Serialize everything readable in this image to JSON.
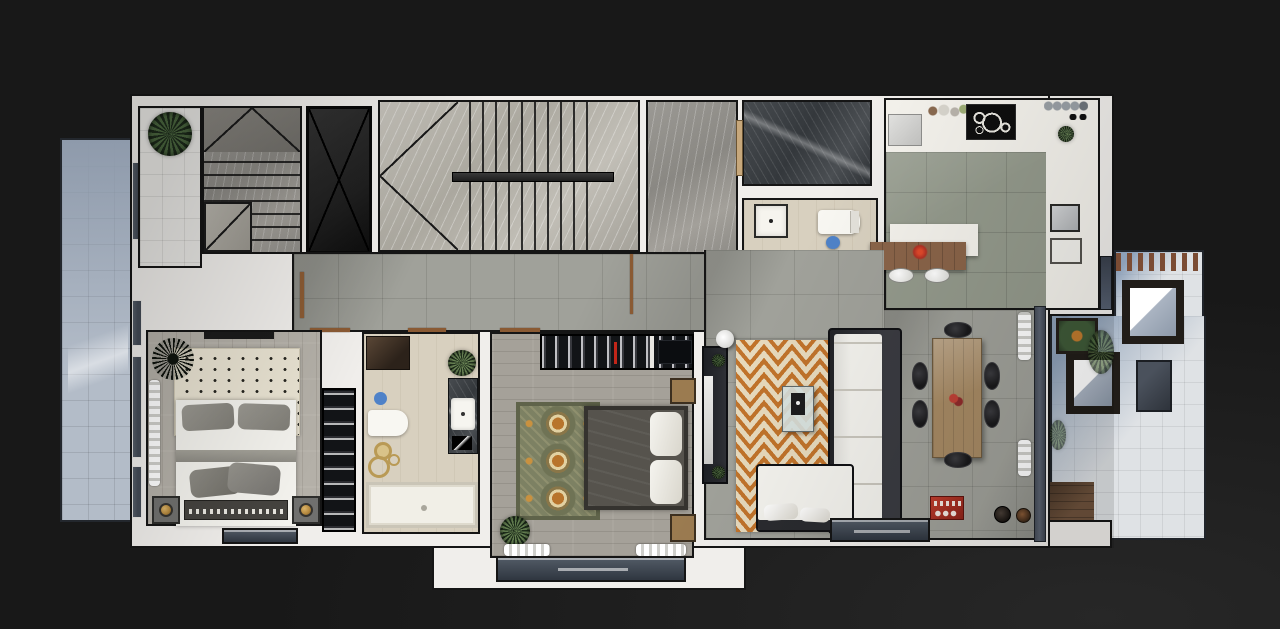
{
  "meta": {
    "scene": "apartment-floor-plan-3d-top-view",
    "text_visible": false
  },
  "palette": {
    "bg": "#181818",
    "bg_glow": "#272727",
    "wall": "#f0eeeb",
    "line": "#151515",
    "balcony_tile": "#b3bcc8",
    "balcony_tile_dark": "#8e9aab",
    "terrace_tile": "#dfe2e5",
    "terrace_shadow": "#8da0b8",
    "white_tile": "#e9e8e5",
    "concrete": "#a0a19a",
    "kitchen_tile": "#949a8c",
    "marble_light": "#bdbab2",
    "marble_mid": "#918f8a",
    "elevator": "#202020",
    "wood_light": "#b4b0a8",
    "wood_mid": "#a5a199",
    "beige": "#d8d0bf",
    "rug_cream": "#e9e3d2",
    "rug_orange": "#c0732b",
    "rug_tan": "#e6d9bc",
    "rug_green": "#7d8163",
    "rug_green_dark": "#5f634a",
    "closet": "#121417",
    "frame_dark": "#2a2b2f",
    "cushion": "#f3f2ed",
    "duvet_gray": "#8d8b84",
    "duvet_dark": "#56534d",
    "bedframe": "#45433f",
    "wood_table": "#a78a64",
    "island_wood": "#8a6449",
    "chair": "#19191b",
    "red": "#b23124",
    "gold": "#b5893f",
    "plant_green": "#3f5a38",
    "deck": "#6e523c",
    "door": "#8a5a33",
    "glass": "#5a6270",
    "window": "#434a55",
    "steel": "#c9ccce",
    "counter_white": "#f4f2ec",
    "cooktop": "#0e0e0e"
  },
  "rooms": [
    {
      "id": "left-balcony",
      "floor": "blue-gray tile",
      "items": [
        "window-wall"
      ]
    },
    {
      "id": "entry-foyer",
      "floor": "white tile",
      "items": [
        "leafy-plant"
      ]
    },
    {
      "id": "service-stairs",
      "floor": "marble",
      "items": [
        "treads",
        "winders",
        "dashed-flight"
      ]
    },
    {
      "id": "elevator-shaft",
      "floor": "dark",
      "items": [
        "x-brace"
      ]
    },
    {
      "id": "main-staircase",
      "floor": "marble",
      "items": [
        "double-flight",
        "center-rail",
        "winders"
      ]
    },
    {
      "id": "stair-landing",
      "floor": "gray marble",
      "items": []
    },
    {
      "id": "shaft-room",
      "floor": "dark marble",
      "items": []
    },
    {
      "id": "guest-wc",
      "floor": "beige",
      "items": [
        "washbasin",
        "toilet",
        "blue-bin",
        "door"
      ]
    },
    {
      "id": "kitchen",
      "floor": "green-gray tile + white band",
      "items": [
        "fridge",
        "sink-dishes",
        "cooktop",
        "dish-rack",
        "plant",
        "wall-sink",
        "appliance",
        "island-counter",
        "wood-bar-table",
        "red-flowers",
        "stools",
        "terrace-slider"
      ]
    },
    {
      "id": "hallway",
      "floor": "concrete tile",
      "items": [
        "door-thresholds",
        "door-leaf"
      ]
    },
    {
      "id": "master-bedroom",
      "floor": "light wood planks",
      "items": [
        "dotted-rug",
        "spiky-plant",
        "curtain",
        "wall-shelf",
        "double-bed",
        "gray-pillows",
        "blanket-pile",
        "footboard",
        "nightstands",
        "gold-lamps",
        "wardrobe-column",
        "juliet-window"
      ]
    },
    {
      "id": "bathroom",
      "floor": "beige",
      "items": [
        "shower",
        "toilet",
        "blue-bin",
        "gold-decor",
        "vanity",
        "sink",
        "plant",
        "bathtub"
      ]
    },
    {
      "id": "bedroom-2",
      "floor": "gray wood planks",
      "items": [
        "wardrobe",
        "ornate-rug",
        "double-bed",
        "white-pillows",
        "nightstands",
        "plant",
        "curtains",
        "balcony"
      ]
    },
    {
      "id": "living-dining",
      "floor": "concrete tile",
      "items": [
        "tv-console",
        "tv",
        "floor-lamp",
        "chevron-rug",
        "l-sofa",
        "coffee-table",
        "dining-table",
        "six-chairs",
        "red-console",
        "pots",
        "slider-door",
        "curtains",
        "glass-wall"
      ]
    },
    {
      "id": "terrace",
      "floor": "light tile with shadow",
      "items": [
        "wood-railing",
        "lounge-chairs",
        "ottoman",
        "planter",
        "grasses",
        "wood-deck"
      ]
    }
  ]
}
